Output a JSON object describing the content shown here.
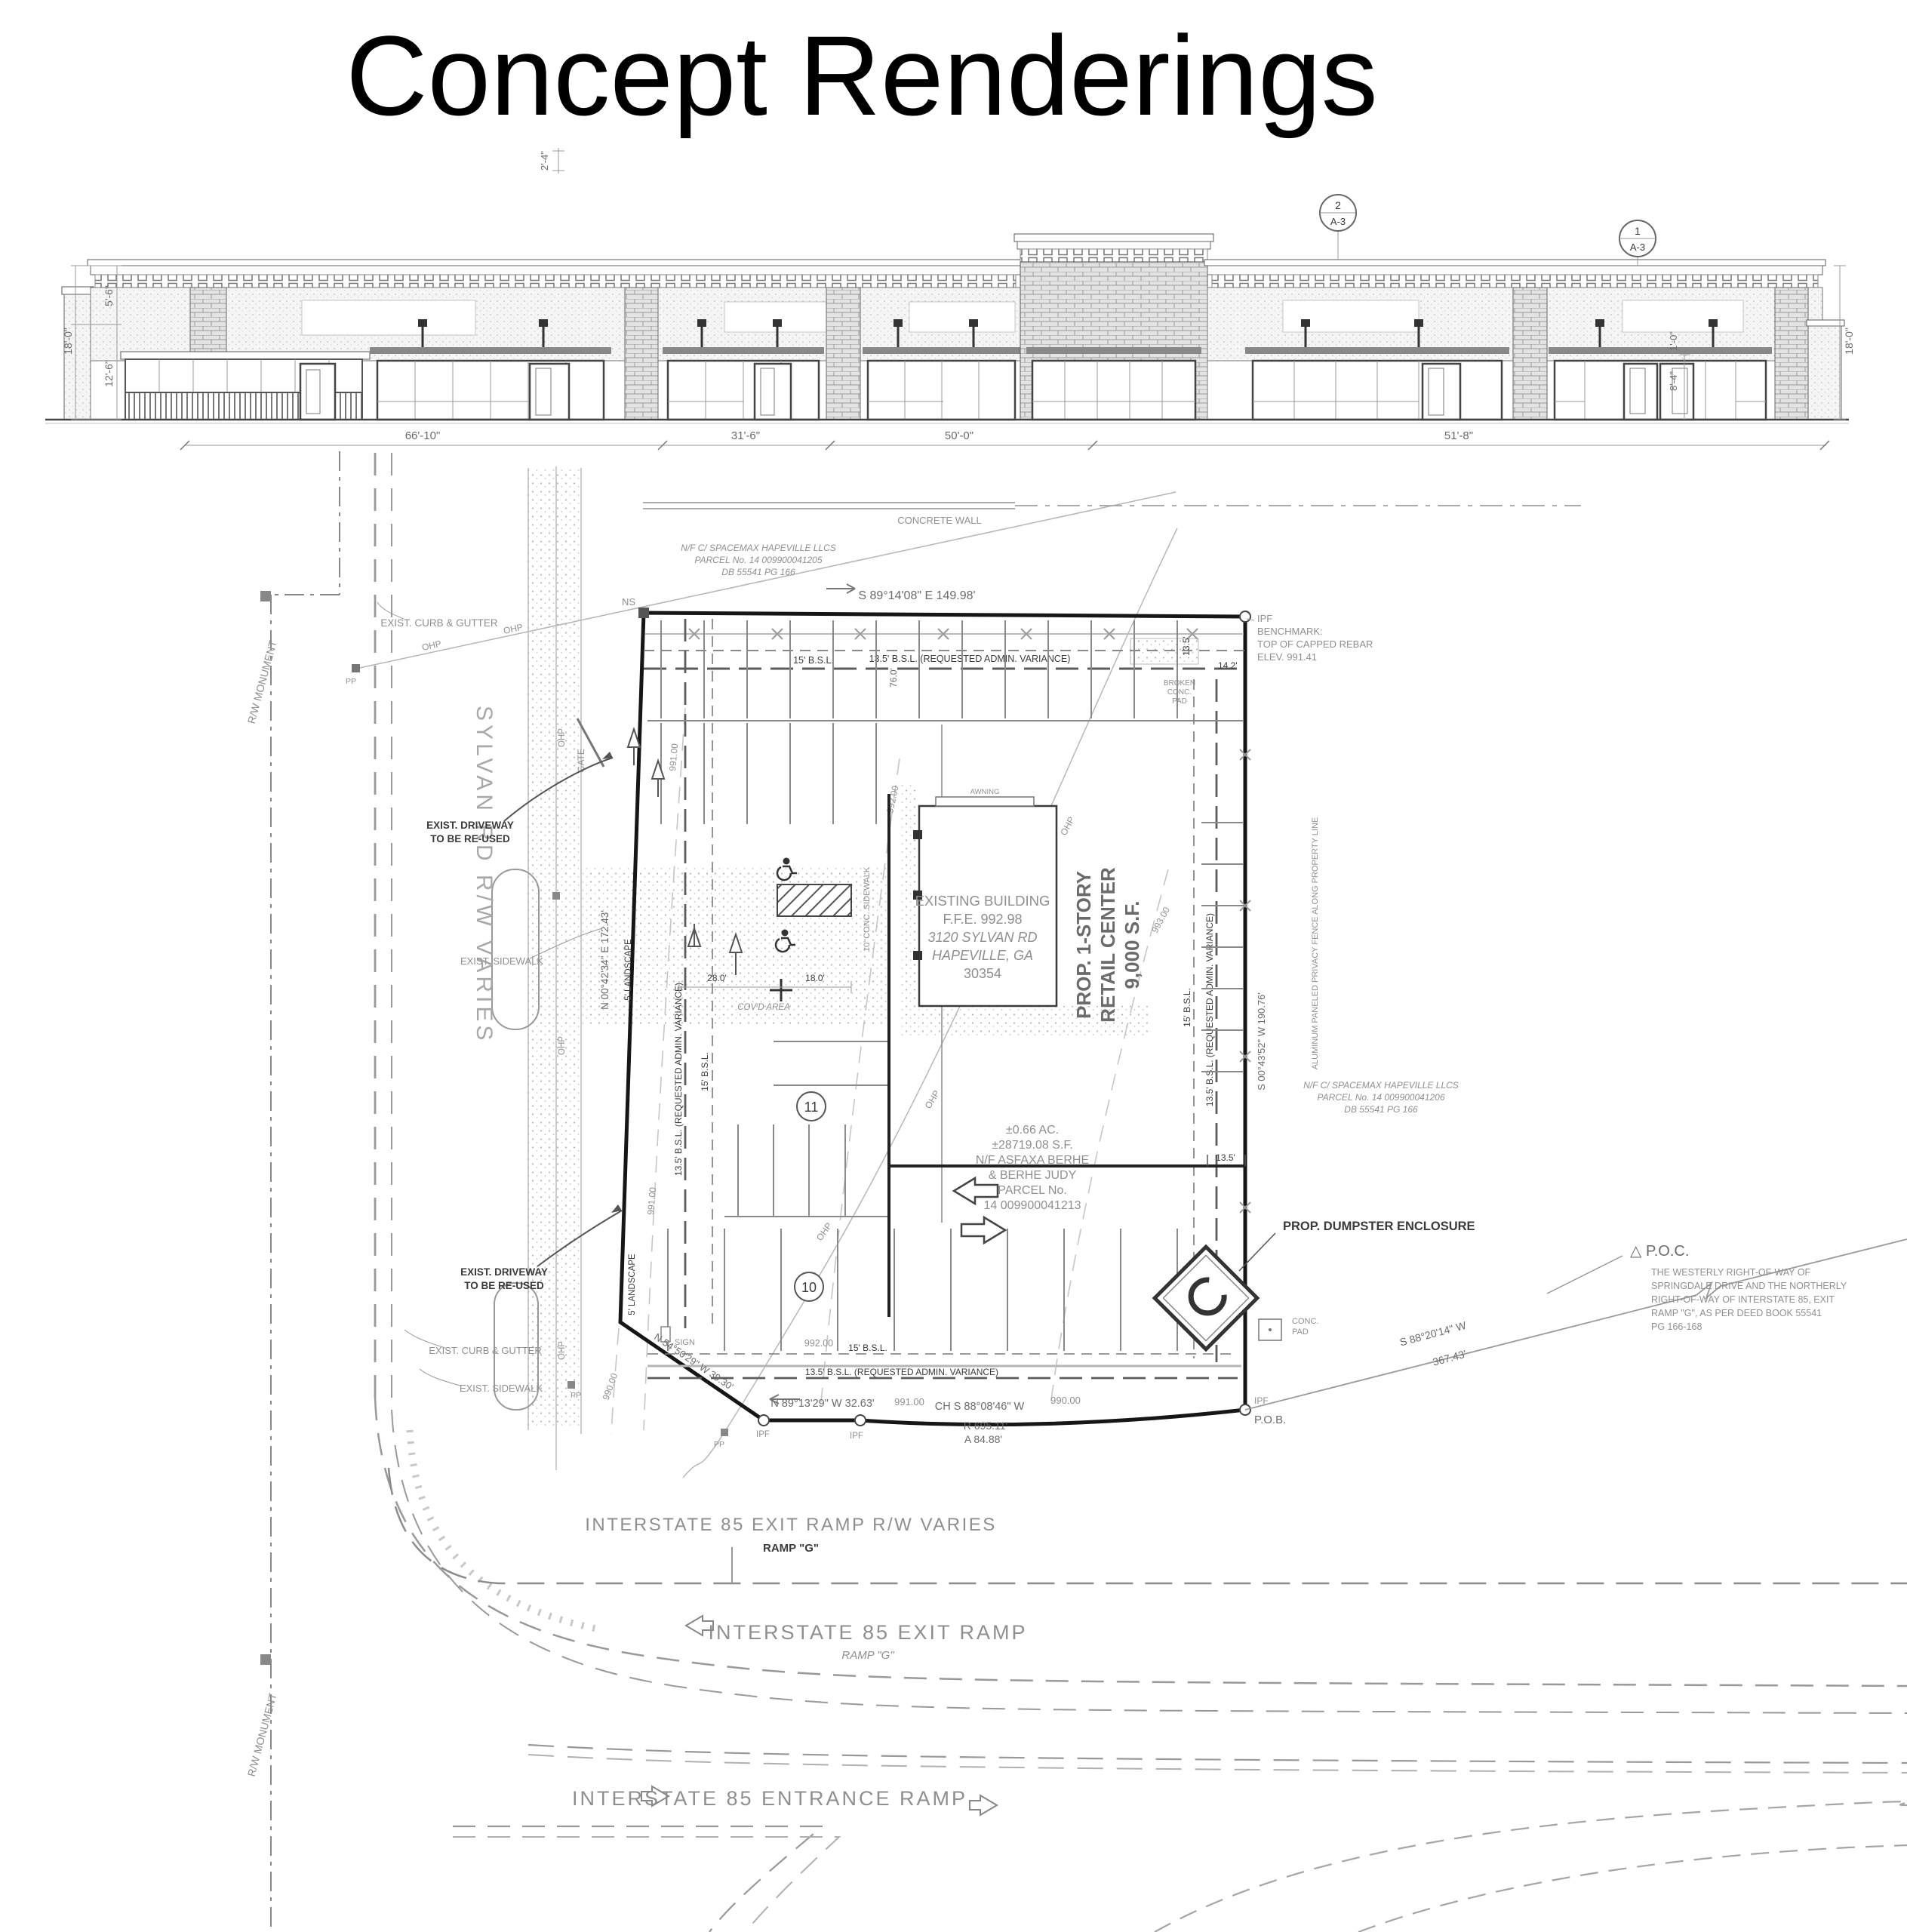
{
  "title": "Concept Renderings",
  "elevation": {
    "callout_top": {
      "num": "2",
      "sheet": "A-3"
    },
    "callout_right": {
      "num": "1",
      "sheet": "A-3"
    },
    "dim_parapet": "2'-4\"",
    "dims_left": [
      "5'-6\"",
      "18'-0\"",
      "12'-6\""
    ],
    "dims_right": [
      "1'-0\"",
      "8'-4\"",
      "18'-0\""
    ],
    "dims_bottom": [
      "66'-10\"",
      "31'-6\"",
      "50'-0\"",
      "51'-8\""
    ]
  },
  "plan": {
    "concrete_wall": "CONCRETE WALL",
    "parcel_north": [
      "N/F C/ SPACEMAX HAPEVILLE LLCS",
      "PARCEL No. 14 009900041205",
      "DB 55541 PG 166"
    ],
    "parcel_east": [
      "N/F C/ SPACEMAX HAPEVILLE LLCS",
      "PARCEL No. 14 009900041206",
      "DB 55541 PG 166"
    ],
    "parcel_site": [
      "±0.66 AC.",
      "±28719.08 S.F.",
      "N/F ASFAXA BERHE",
      "& BERHE JUDY",
      "PARCEL No.",
      "14 009900041213"
    ],
    "building": [
      "EXISTING BUILDING",
      "F.F.E. 992.98",
      "3120 SYLVAN RD",
      "HAPEVILLE, GA",
      "30354"
    ],
    "retail": [
      "PROP. 1-STORY",
      "RETAIL CENTER",
      "9,000 S.F."
    ],
    "awning": "AWNING",
    "benchmark": [
      "IPF",
      "BENCHMARK:",
      "TOP OF CAPPED REBAR",
      "ELEV. 991.41"
    ],
    "poc": [
      "△ P.O.C.",
      "THE WESTERLY RIGHT-OF-WAY OF",
      "SPRINGDALE DRIVE AND THE NORTHERLY",
      "RIGHT-OF-WAY OF INTERSTATE 85, EXIT",
      "RAMP \"G\", AS PER DEED BOOK 55541",
      "PG 166-168"
    ],
    "pob": "P.O.B.",
    "ipf": "IPF",
    "ns": "NS",
    "pp": "PP",
    "ohp": "OHP",
    "gate": "GATE",
    "sign": "SIGN",
    "bearing_top": "S 89°14'08\" E   149.98'",
    "bearing_left": "N 00°42'34\" E   172.43'",
    "bearing_right": "S 00°43'52\" W   190.76'",
    "bearing_bottom": "N 89°13'29\" W   32.63'",
    "bearing_diag": "N 54°50'29\" W   39.30'",
    "chord": "CH S 88°08'46\" W",
    "radius": "R  695.11'",
    "arc_len": "A  84.88'",
    "bearing_se": [
      "S 88°20'14\" W",
      "367.43'"
    ],
    "bsl_15": "15' B.S.L.",
    "bsl_135": "13.5' B.S.L. (REQUESTED ADMIN. VARIANCE)",
    "landscape": "5' LANDSCAPE",
    "sidewalk_10": "10' CONC. SIDEWALK",
    "covd_area": "COV'D AREA",
    "dims": {
      "d280": "28.0'",
      "d180": "18.0'",
      "d76": "76.0'",
      "d135": "13.5'",
      "d142": "14.2'"
    },
    "contours": {
      "c990": "990.00",
      "c991": "991.00",
      "c992": "992.00",
      "c993": "993.00"
    },
    "sylvan_rd": "SYLVAN RD R/W VARIES",
    "rw_monument": "R/W MONUMENT",
    "exist_curb": "EXIST. CURB & GUTTER",
    "exist_sidewalk": "EXIST. SIDEWALK",
    "exist_driveway": [
      "EXIST. DRIVEWAY",
      "TO BE RE-USED"
    ],
    "dumpster": "PROP. DUMPSTER ENCLOSURE",
    "conc_pad": [
      "CONC.",
      "PAD"
    ],
    "broken_pad": [
      "BROKEN",
      "CONC.",
      "PAD"
    ],
    "fence_note": "ALUMINUM PANELED PRIVACY FENCE ALONG PROPERTY LINE",
    "exit_rw": "INTERSTATE 85 EXIT RAMP R/W VARIES",
    "exit_ramp": "INTERSTATE 85 EXIT RAMP",
    "entrance_ramp": "INTERSTATE 85 ENTRANCE RAMP",
    "ramp_g": "RAMP \"G\"",
    "stall_counts": {
      "row_a": "11",
      "row_b": "10"
    }
  }
}
